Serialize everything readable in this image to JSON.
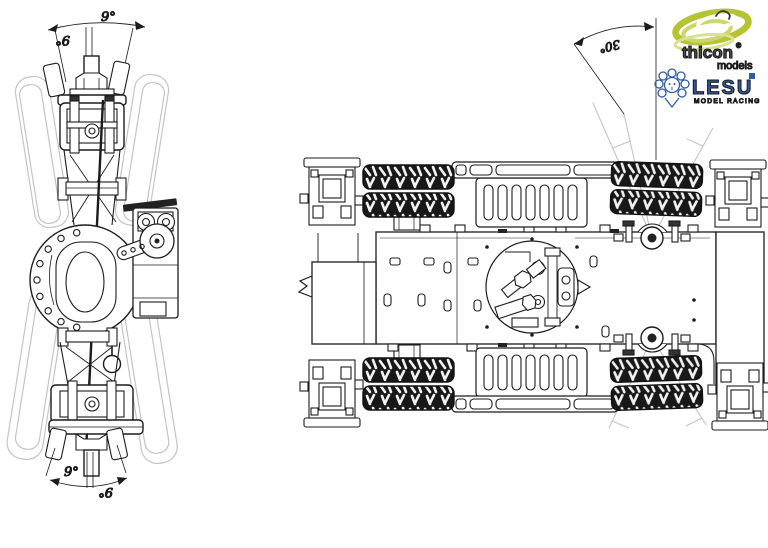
{
  "axle_view": {
    "dim_top_right": "9°",
    "dim_top_left": "9°",
    "dim_bottom_left": "9°",
    "dim_bottom_right": "9°"
  },
  "chassis_view": {
    "dim_steering": "30°"
  },
  "logos": {
    "thicon": {
      "brand": "thicon",
      "registered": "®",
      "tagline": "models"
    },
    "lesu": {
      "brand": "LESU",
      "registered": "®",
      "tagline": "MODEL RACING"
    }
  },
  "colors": {
    "line_dark": "#1c1c1c",
    "line_light": "#c4c4c4",
    "thicon_green": "#b6c434",
    "thicon_light_green": "#d4dd86",
    "thicon_text_gray": "#4c4c4c",
    "lesu_blue": "#2e5ca8"
  }
}
